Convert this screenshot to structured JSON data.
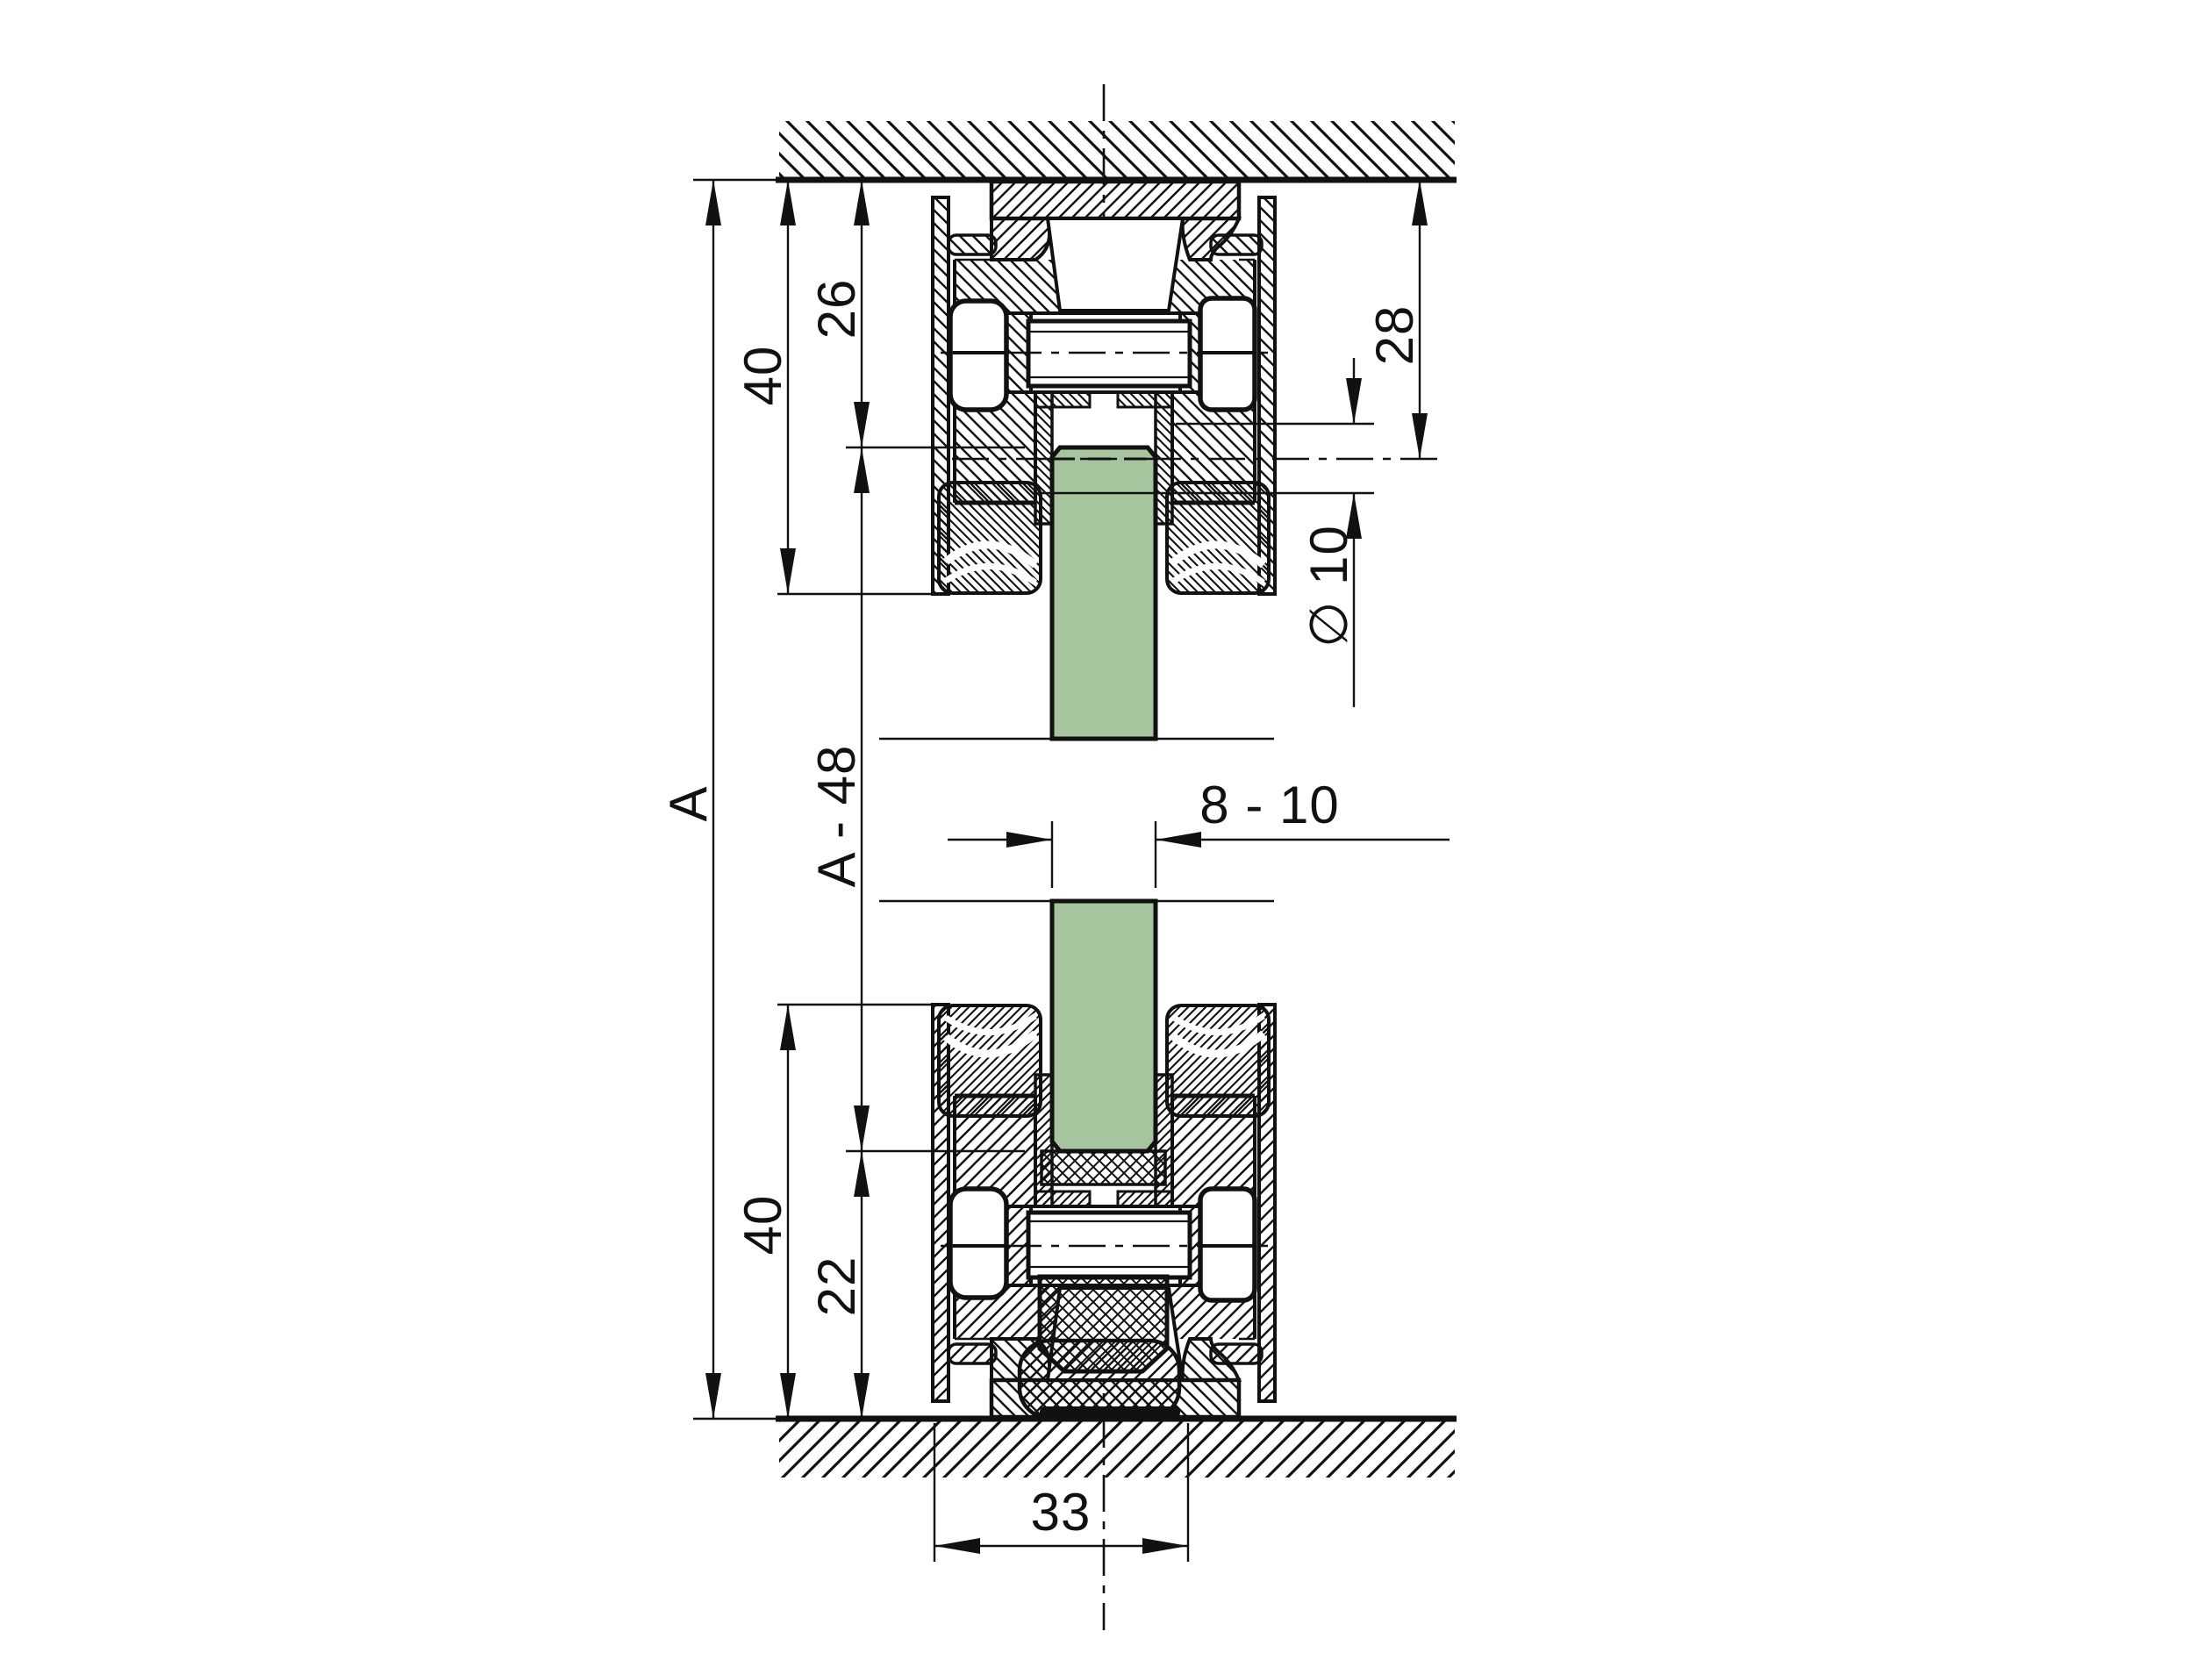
{
  "drawing": {
    "kind": "technical cross-section, glass clamp profile between ceiling and floor",
    "colors": {
      "line": "#111111",
      "glass_fill": "#a6c59f",
      "background": "#ffffff"
    },
    "labels": {
      "overall_height": "A",
      "top_profile_height": "40",
      "top_glass_inset": "26",
      "glass_length": "A - 48",
      "bottom_glass_inset": "22",
      "bottom_profile_height": "40",
      "ceiling_to_pin_axis": "28",
      "pin_diameter": "∅ 10",
      "glass_thickness": "8 - 10",
      "profile_width": "33"
    }
  }
}
